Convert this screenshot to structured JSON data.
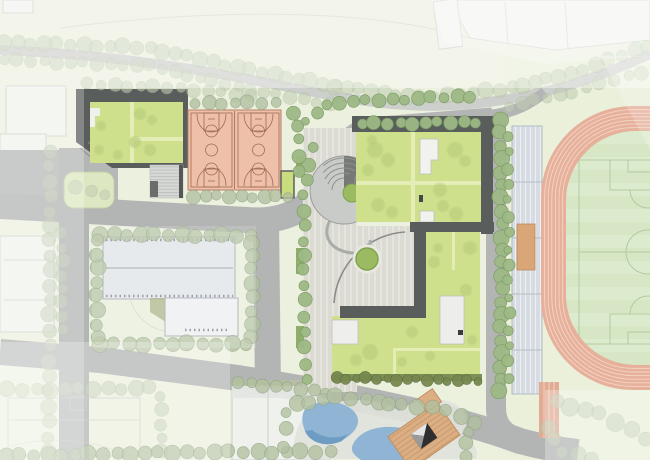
{
  "meta": {
    "kind": "architectural-site-plan",
    "visible_text": []
  },
  "palette": {
    "bg": "#ecf0de",
    "road": "#b3b5b5",
    "roadContext": "#c7c9c9",
    "darkRoof": "#595d5b",
    "greenRoof": "#cfe08c",
    "greenPath": "#e4edb6",
    "treeBright": "#9db985",
    "treeMid": "#b2c1a0",
    "treeFaded": "#c2cdb4",
    "treeDark": "#76884f",
    "court": "#eec0aa",
    "courtLine": "#a06a50",
    "track": "#e6b09b",
    "trackLine": "#f3d2c3",
    "infield": "#d7e7c6",
    "pitchLine": "#b3c9a0",
    "plaza": "#dbdbd3",
    "plazaLine": "#ecece4",
    "water": "#8fb4d4",
    "waterDark": "#6f9cc2",
    "deck": "#dcae83",
    "bleacher": "#d6dce2",
    "bench": "#d9a678",
    "hedgeGreen": "#8fae6a",
    "context": "#f2f3f0",
    "contextStroke": "#ccd0cc"
  },
  "features": [
    {
      "name": "running-track",
      "kind": "sports",
      "color": "#e6b09b"
    },
    {
      "name": "soccer-infield",
      "kind": "sports",
      "color": "#d7e7c6"
    },
    {
      "name": "basketball-courts",
      "kind": "sports",
      "count": 2,
      "color": "#eec0aa"
    },
    {
      "name": "grandstand-bleachers",
      "kind": "structure",
      "color": "#d6dce2"
    },
    {
      "name": "green-roof-school-buildings",
      "kind": "building",
      "color": "#cfe08c"
    },
    {
      "name": "dark-roof-courtyard-building",
      "kind": "building",
      "color": "#595d5b"
    },
    {
      "name": "spiral-amphitheater",
      "kind": "landscape",
      "color": "#c8cbc8"
    },
    {
      "name": "central-paved-plaza",
      "kind": "landscape",
      "color": "#dbdbd3"
    },
    {
      "name": "pond-water-garden",
      "kind": "landscape",
      "color": "#8fb4d4"
    },
    {
      "name": "timber-deck-pavilion",
      "kind": "structure",
      "color": "#dcae83"
    },
    {
      "name": "campus-roads",
      "kind": "infrastructure",
      "color": "#b3b5b5"
    },
    {
      "name": "street-trees",
      "kind": "vegetation",
      "color": "#9db985"
    },
    {
      "name": "context-buildings",
      "kind": "context",
      "color": "#f2f3f0"
    }
  ]
}
